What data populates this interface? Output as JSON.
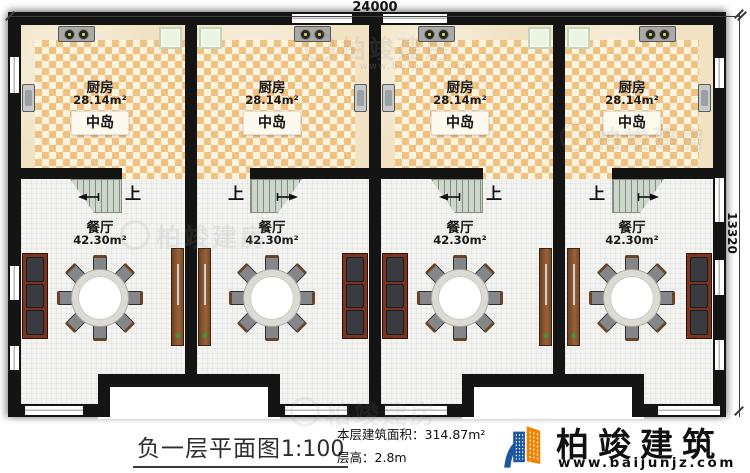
{
  "dimensions": {
    "top": "24000",
    "right": "13320"
  },
  "units": [
    {
      "kitchen_name": "厨房",
      "kitchen_area": "28.14m²",
      "island": "中岛",
      "dining_name": "餐厅",
      "dining_area": "42.30m²",
      "stairs_up": "上"
    },
    {
      "kitchen_name": "厨房",
      "kitchen_area": "28.14m²",
      "island": "中岛",
      "dining_name": "餐厅",
      "dining_area": "42.30m²",
      "stairs_up": "上"
    },
    {
      "kitchen_name": "厨房",
      "kitchen_area": "28.14m²",
      "island": "中岛",
      "dining_name": "餐厅",
      "dining_area": "42.30m²",
      "stairs_up": "上"
    },
    {
      "kitchen_name": "厨房",
      "kitchen_area": "28.14m²",
      "island": "中岛",
      "dining_name": "餐厅",
      "dining_area": "42.30m²",
      "stairs_up": "上"
    }
  ],
  "title": {
    "text": "负一层平面图",
    "scale": "1:100"
  },
  "info": {
    "floor_area_label": "本层建筑面积：",
    "floor_area_value": "314.87m²",
    "floor_height_label": "层高：",
    "floor_height_value": "2.8m"
  },
  "brand": {
    "name": "柏竣建筑",
    "website": "www.baijunjz.com"
  },
  "watermark": {
    "text": "柏竣建房",
    "website": "www.baijunjz.com"
  },
  "colors": {
    "wall": "#141414",
    "kitchen_check_a": "#efc183",
    "kitchen_check_b": "#fdf3dc",
    "counter": "#f1e2c3",
    "dining_floor": "#f3f3f1",
    "stairs": "#ccd6cb",
    "sofa_frame": "#7a341f",
    "sofa_cushion": "#3a3b40",
    "cabinet_wood": "#8a5530",
    "fridge": "#ebf3e2",
    "logo_blue": "#1b57a0",
    "logo_orange": "#f08300"
  }
}
